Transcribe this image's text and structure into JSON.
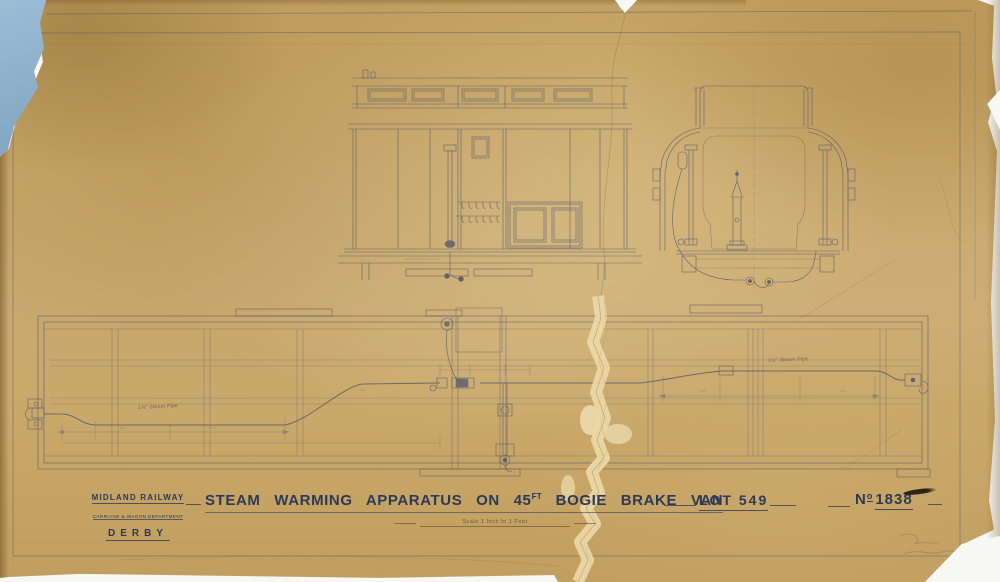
{
  "document": {
    "company": "MIDLAND RAILWAY",
    "department": "CARRIAGE & WAGON DEPARTMENT",
    "location": "DERBY",
    "title_main": "STEAM WARMING APPARATUS ON 45",
    "title_unit_sup": "FT",
    "title_rest": "BOGIE BRAKE VAN",
    "lot": "LOT 549",
    "number_prefix": "N",
    "number_sup": "o",
    "number": "1838",
    "scale_note": "Scale 1 Inch to 1 Foot"
  },
  "annotations": {
    "steam_pipe_label_left": "1¼\" Steam Pipe",
    "steam_pipe_label_right": "1¼\" Steam Pipe"
  },
  "views": {
    "side_elevation": "interior side elevation of brake van",
    "end_section": "end cross-section of brake van with stove",
    "underframe_plan": "plan of underframe with steam warming pipe"
  },
  "colors": {
    "paper": "#c8a76b",
    "ink": "#46506a",
    "title_ink": "#2d3a56",
    "backing_blue": "#8fb3ce",
    "scan_background": "#f7f7f4",
    "tear_cream": "#ecd9a8"
  }
}
